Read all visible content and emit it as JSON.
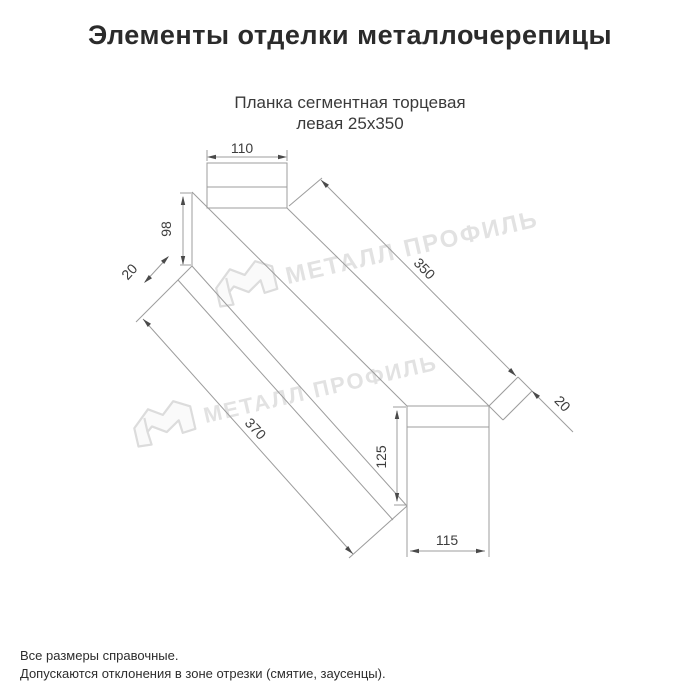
{
  "header": {
    "title": "Элементы отделки металлочерепицы"
  },
  "product": {
    "name_line1": "Планка сегментная торцевая",
    "name_line2": "левая 25х350"
  },
  "diagram": {
    "dim_top_width": "110",
    "dim_far_web_height": "98",
    "dim_far_flap": "20",
    "dim_edge_length": "350",
    "dim_overall_length": "370",
    "dim_near_web_height": "125",
    "dim_bottom_width": "115",
    "dim_near_flap": "20"
  },
  "watermark": {
    "brand": "МЕТАЛЛ ПРОФИЛЬ"
  },
  "footer": {
    "note1": "Все размеры справочные.",
    "note2": "Допускаются отклонения в зоне отрезки (смятие, заусенцы)."
  },
  "colors": {
    "line": "#9c9c9c",
    "arrow": "#4a4a4a",
    "dim_text": "#3d3d3d",
    "watermark": "#e2e2e2",
    "title": "#2b2b2b"
  }
}
